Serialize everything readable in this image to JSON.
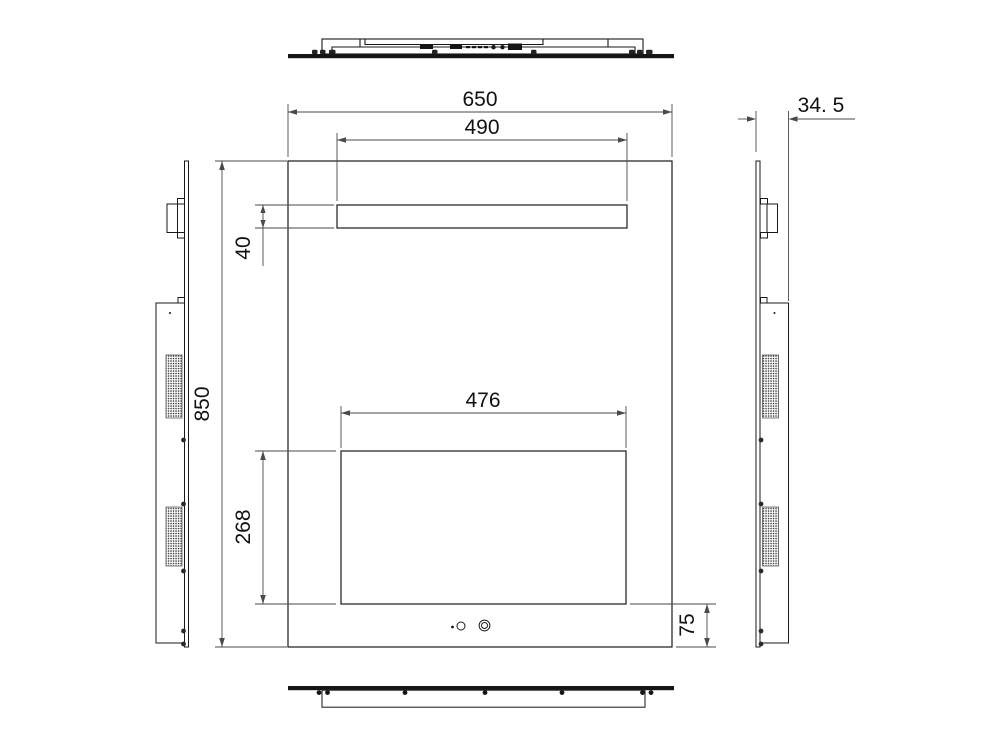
{
  "drawing": {
    "colors": {
      "background": "#ffffff",
      "object_line": "#1a1a1a",
      "dimension_line": "#4a4a4a",
      "text": "#111111"
    },
    "dimensions": {
      "total_width": "650",
      "light_width": "490",
      "depth": "34. 5",
      "total_height": "850",
      "light_height": "40",
      "screen_width": "476",
      "screen_height": "268",
      "bottom_margin": "75"
    }
  }
}
